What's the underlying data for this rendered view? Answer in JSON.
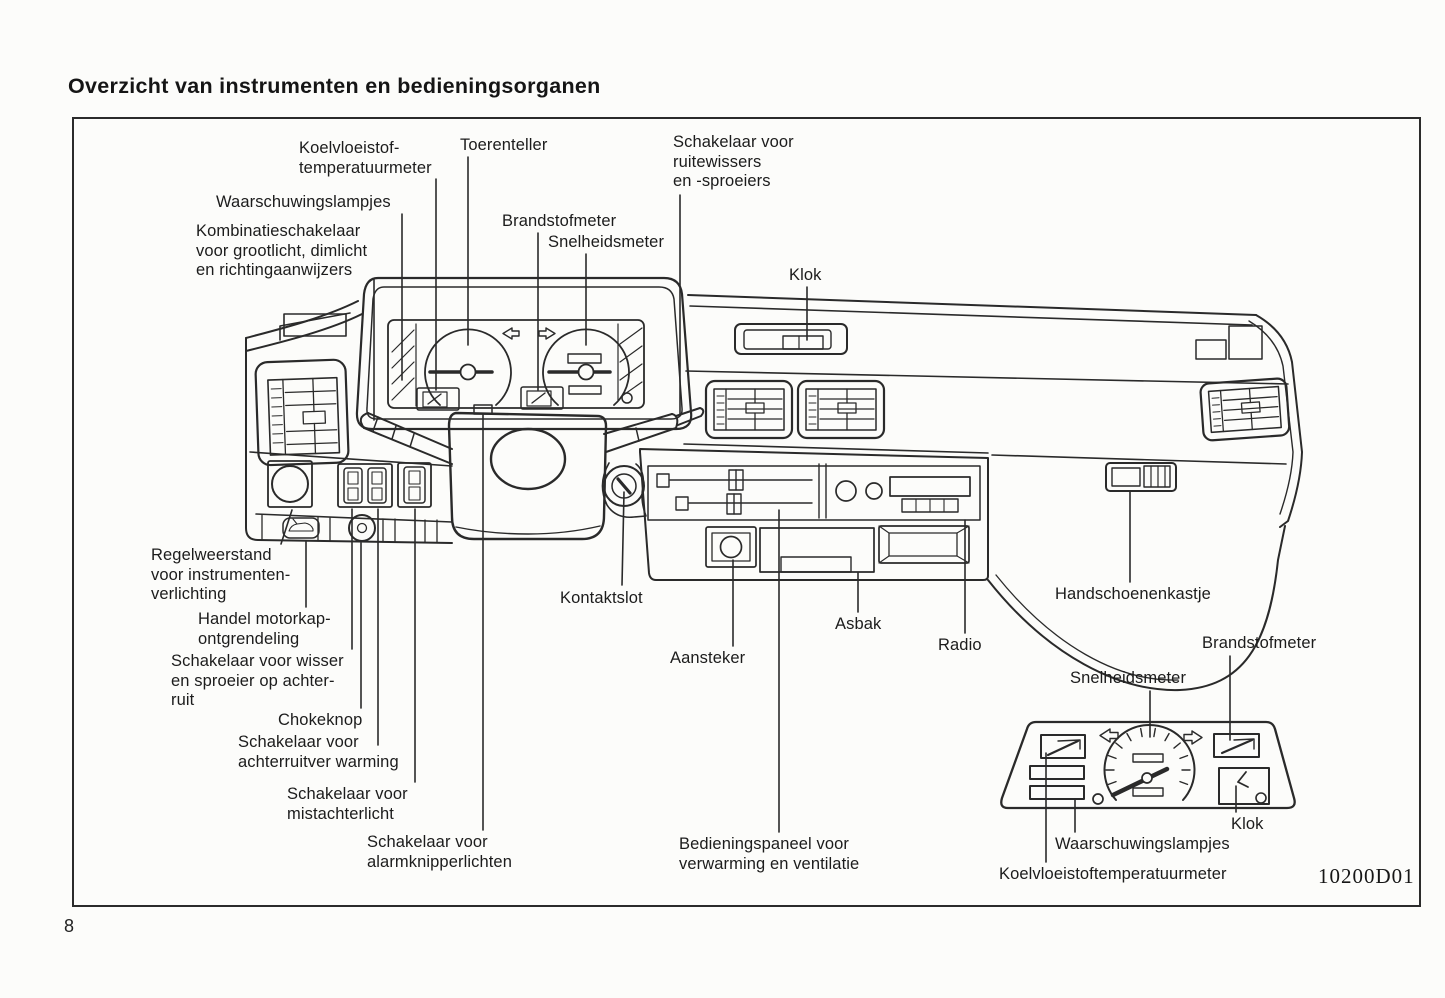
{
  "page": {
    "title": "Overzicht van instrumenten en bedieningsorganen",
    "page_number": "8",
    "figure_code": "10200D01"
  },
  "colors": {
    "ink": "#2a2a2a",
    "paper": "#fcfcfa"
  },
  "callouts": {
    "koelvloeistoftemperatuurmeter": "Koelvloeistof-\ntemperatuurmeter",
    "toerenteller": "Toerenteller",
    "ruitewissers": "Schakelaar voor\nruitewissers\nen -sproeiers",
    "waarschuwingslampjes": "Waarschuwingslampjes",
    "kombinatieschakelaar": "Kombinatieschakelaar\nvoor grootlicht, dimlicht\nen richtingaanwijzers",
    "brandstofmeter": "Brandstofmeter",
    "snelheidsmeter": "Snelheidsmeter",
    "klok": "Klok",
    "regelweerstand": "Regelweerstand\nvoor instrumenten-\nverlichting",
    "motorkap": "Handel motorkap-\nontgrendeling",
    "wisser_achterruit": "Schakelaar voor wisser\nen sproeier op achter-\nruit",
    "chokeknop": "Chokeknop",
    "achterruitverwarming": "Schakelaar voor\nachterruitver warming",
    "mistachterlicht": "Schakelaar voor\nmistachterlicht",
    "alarmknipperlichten": "Schakelaar voor\nalarmknipperlichten",
    "kontaktslot": "Kontaktslot",
    "aansteker": "Aansteker",
    "asbak": "Asbak",
    "radio": "Radio",
    "bedieningspaneel": "Bedieningspaneel voor\nverwarming en ventilatie",
    "handschoenenkastje": "Handschoenenkastje"
  },
  "inset_labels": {
    "snelheidsmeter": "Snelheidsmeter",
    "brandstofmeter": "Brandstofmeter",
    "klok": "Klok",
    "waarschuwingslampjes": "Waarschuwingslampjes",
    "koelvloeistoftemperatuurmeter": "Koelvloeistoftemperatuurmeter"
  }
}
